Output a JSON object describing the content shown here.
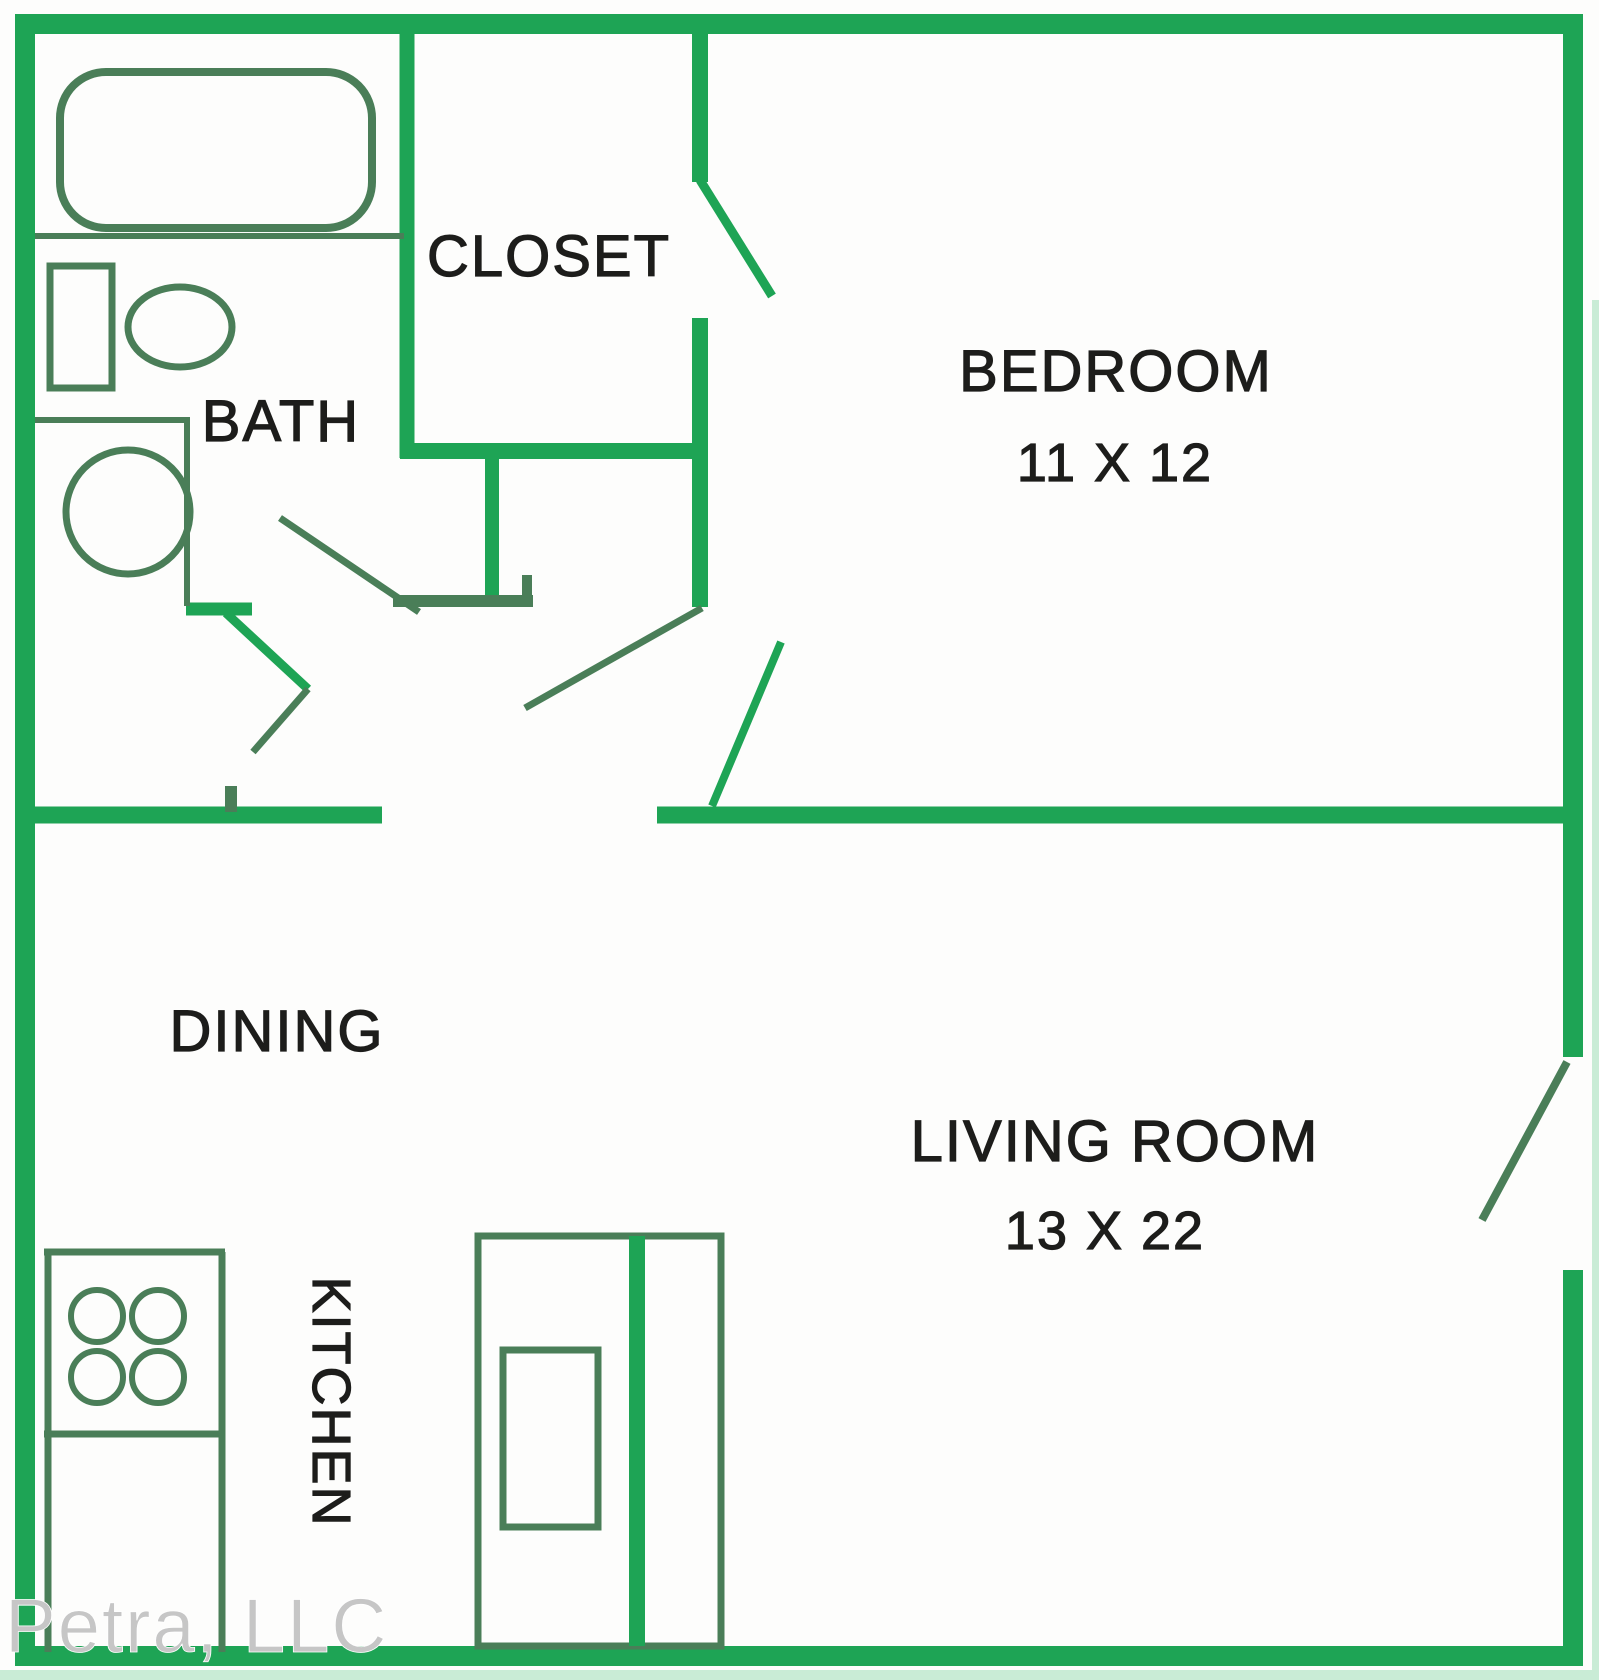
{
  "title": "One bedroom apartment floor plan",
  "colors": {
    "wall": "#1ea455",
    "wall_light": "#c9ecd6",
    "fixture": "#4a7e58",
    "label": "#1d1d1b",
    "watermark": "#c6c6c6",
    "bg": "#fdfdfc"
  },
  "rooms": {
    "closet": {
      "label": "CLOSET"
    },
    "bath": {
      "label": "BATH"
    },
    "bedroom": {
      "label": "BEDROOM",
      "dimensions": "11 X 12"
    },
    "dining": {
      "label": "DINING"
    },
    "kitchen": {
      "label": "KITCHEN"
    },
    "living_room": {
      "label": "LIVING ROOM",
      "dimensions": "13 X 22"
    }
  },
  "watermark": {
    "text": "Petra, LLC"
  },
  "fixtures": {
    "bathtub-icon": "rounded-rectangle-tub",
    "toilet-icon": "tank-and-bowl",
    "washer-icon": "circle-in-square",
    "stove-icon": "four-burner-circles",
    "refrigerator-icon": "double-door-with-handle"
  }
}
